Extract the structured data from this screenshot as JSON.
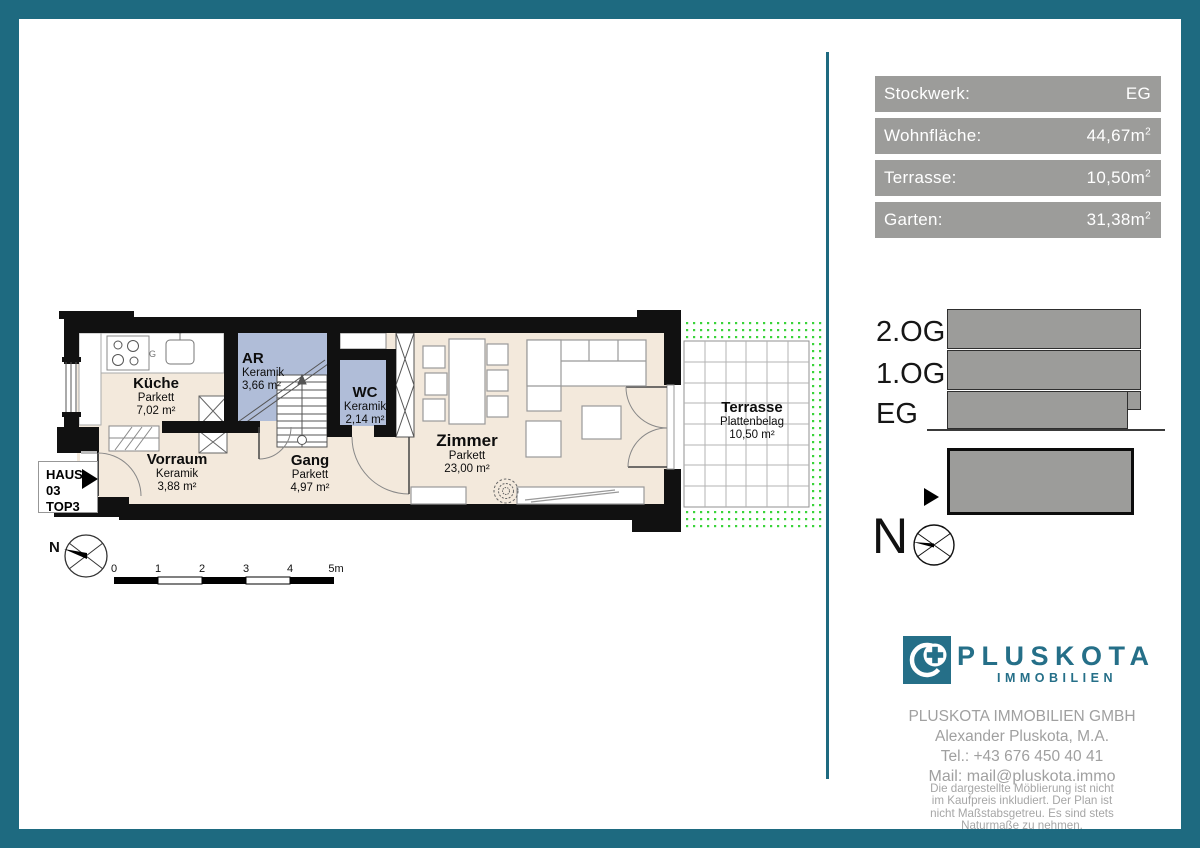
{
  "info_panel": {
    "rows": [
      {
        "label": "Stockwerk:",
        "value": "EG",
        "sup": ""
      },
      {
        "label": "Wohnfläche:",
        "value": "44,67m",
        "sup": "2"
      },
      {
        "label": "Terrasse:",
        "value": "10,50m",
        "sup": "2"
      },
      {
        "label": "Garten:",
        "value": "31,38m",
        "sup": "2"
      }
    ]
  },
  "section_diagram": {
    "floors": [
      "2.OG",
      "1.OG",
      "EG"
    ],
    "north_label": "N"
  },
  "logo": {
    "brand": "PLUSKOTA",
    "sub": "IMMOBILIEN"
  },
  "contact": {
    "company": "PLUSKOTA IMMOBILIEN GMBH",
    "person": "Alexander Pluskota, M.A.",
    "tel": "Tel.: +43 676 450 40 41",
    "mail": "Mail: mail@pluskota.immo"
  },
  "disclaimer": {
    "lines": [
      "Die dargestellte Möblierung ist nicht",
      "im Kaufpreis inkludiert. Der Plan ist",
      "nicht Maßstabsgetreu. Es sind stets",
      "Naturmaße zu nehmen."
    ]
  },
  "plan": {
    "unit": {
      "line1": "HAUS 03",
      "line2": "TOP3"
    },
    "north_label": "N",
    "kitchen_marker": "G",
    "rooms": [
      {
        "name": "Küche",
        "surface": "Parkett",
        "area": "7,02 m²"
      },
      {
        "name": "AR",
        "surface": "Keramik",
        "area": "3,66 m²"
      },
      {
        "name": "WC",
        "surface": "Keramik",
        "area": "2,14 m²"
      },
      {
        "name": "Vorraum",
        "surface": "Keramik",
        "area": "3,88 m²"
      },
      {
        "name": "Gang",
        "surface": "Parkett",
        "area": "4,97 m²"
      },
      {
        "name": "Zimmer",
        "surface": "Parkett",
        "area": "23,00 m²"
      },
      {
        "name": "Terrasse",
        "surface": "Plattenbelag",
        "area": "10,50 m²"
      }
    ],
    "scale_ticks": [
      "0",
      "1",
      "2",
      "3",
      "4",
      "5m"
    ]
  },
  "colors": {
    "accent_teal": "#1e6a80",
    "logo_teal": "#256f88",
    "box_gray": "#9c9c9a",
    "room_blue": "#b0bdd8",
    "floor_beige": "#f3e9dc",
    "garden_green": "#3ad43a"
  }
}
